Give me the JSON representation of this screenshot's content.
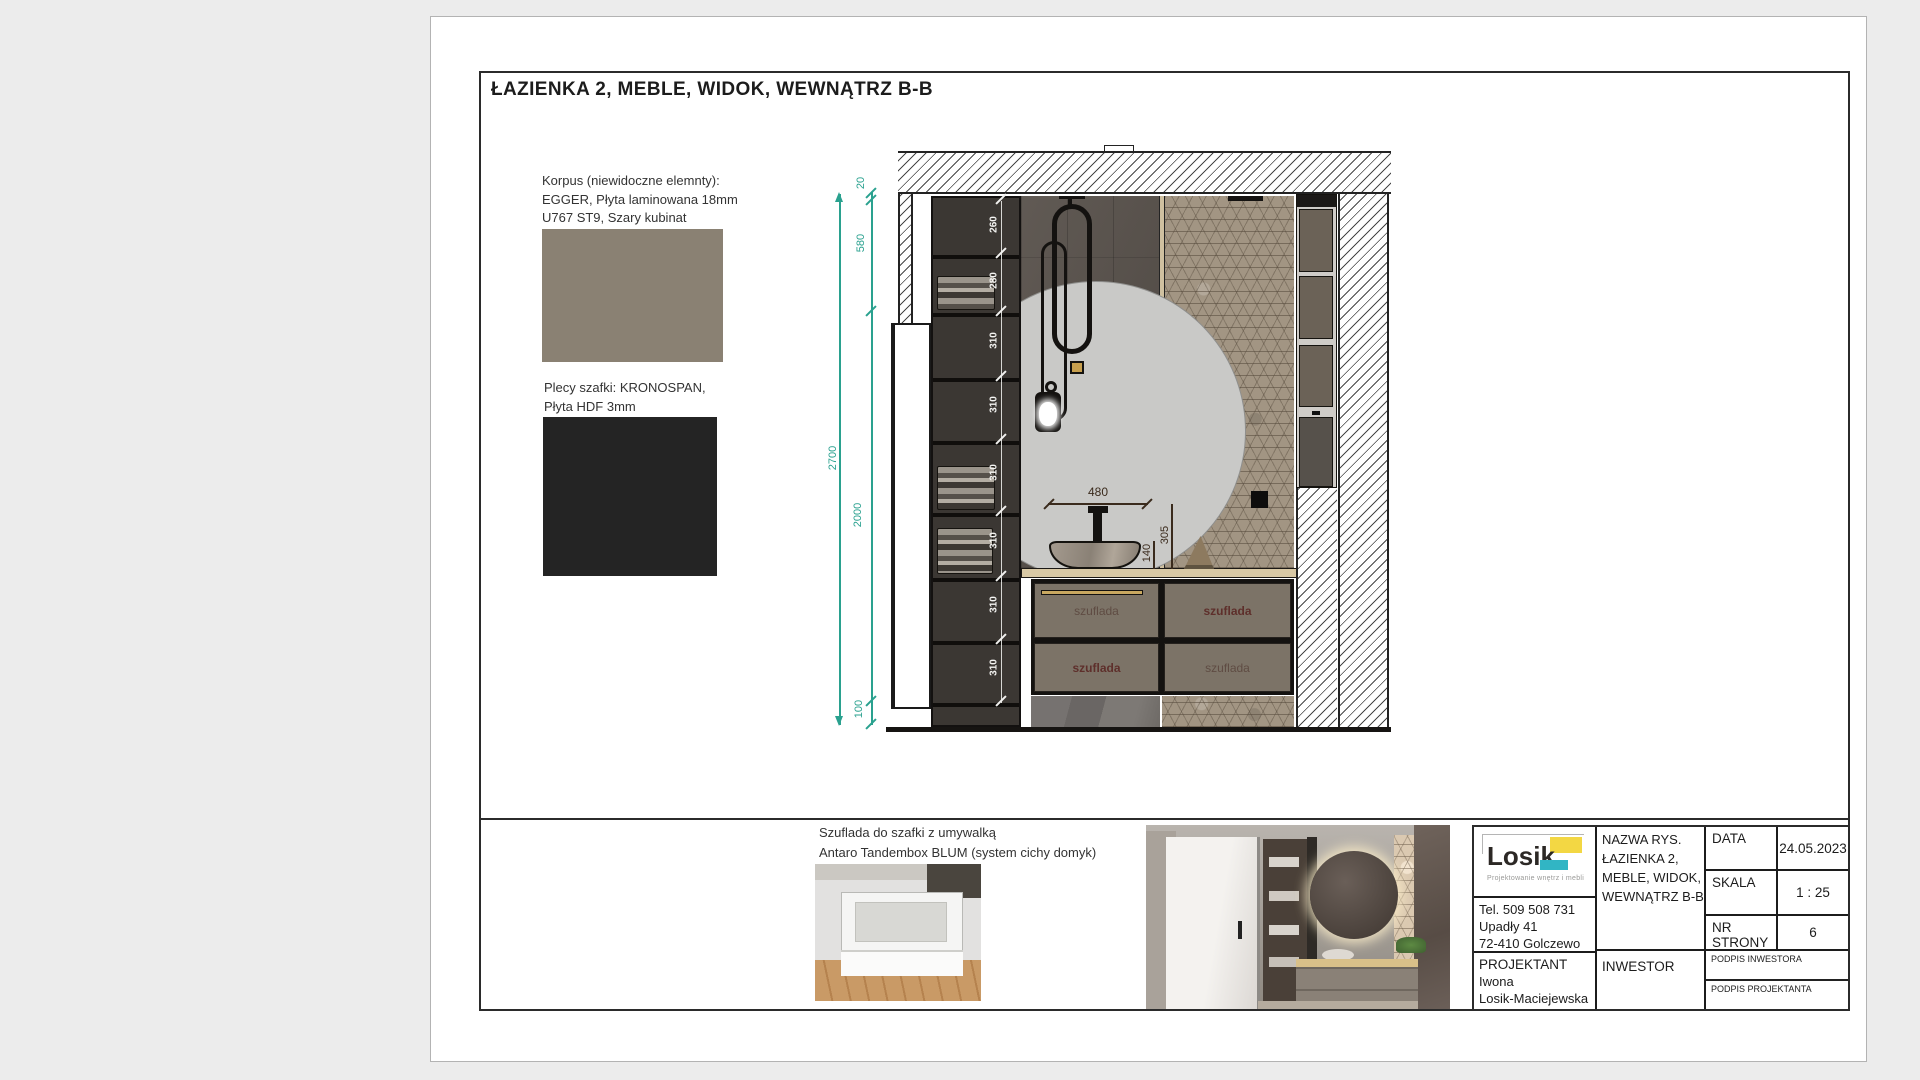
{
  "sheet": {
    "title": "ŁAZIENKA 2, MEBLE, WIDOK, WEWNĄTRZ  B-B",
    "notes": {
      "korpus_line1": "Korpus (niewidoczne elemnty):",
      "korpus_line2": "EGGER, Płyta laminowana 18mm",
      "korpus_line3": "U767 ST9, Szary kubinat",
      "plecy_line1": "Plecy szafki: KRONOSPAN,",
      "plecy_line2": "Płyta HDF 3mm"
    },
    "swatches": {
      "korpus_color": "#8a8173",
      "plecy_color": "#242424"
    }
  },
  "drawing": {
    "accent_teal": "#2aa18f",
    "wall_dims": {
      "total": "2700",
      "top": "20",
      "upper": "580",
      "middle": "2000",
      "bottom": "100"
    },
    "shelf_dims": [
      "260",
      "280",
      "310",
      "310",
      "310",
      "310",
      "310",
      "310"
    ],
    "sink_dims": {
      "width": "480",
      "basin_height": "140",
      "faucet_height": "305"
    },
    "drawer_labels": {
      "tl": "szuflada",
      "tr": "szuflada",
      "bl": "szuflada",
      "br": "szuflada"
    }
  },
  "footer_note": {
    "line1": "Szuflada do szafki z umywalką",
    "line2": "Antaro Tandembox BLUM (system cichy domyk)"
  },
  "title_block": {
    "logo_text": "Losik",
    "logo_sub": "Projektowanie wnętrz i mebli",
    "contact_line1": "Tel.  509 508 731",
    "contact_line2": "Upadły 41",
    "contact_line3": "72-410 Golczewo",
    "projektant_label": "PROJEKTANT",
    "projektant_name1": "Iwona",
    "projektant_name2": "Losik-Maciejewska",
    "nazwa_label": "NAZWA RYS.",
    "nazwa_line1": "ŁAZIENKA 2,",
    "nazwa_line2": "MEBLE, WIDOK,",
    "nazwa_line3": "WEWNĄTRZ  B-B",
    "inwestor_label": "INWESTOR",
    "data_label": "DATA",
    "data_value": "24.05.2023",
    "skala_label": "SKALA",
    "skala_value": "1 : 25",
    "nr_strony_label": "NR STRONY",
    "nr_strony_value": "6",
    "podpis_inwestora": "PODPIS INWESTORA",
    "podpis_projektanta": "PODPIS PROJEKTANTA"
  }
}
